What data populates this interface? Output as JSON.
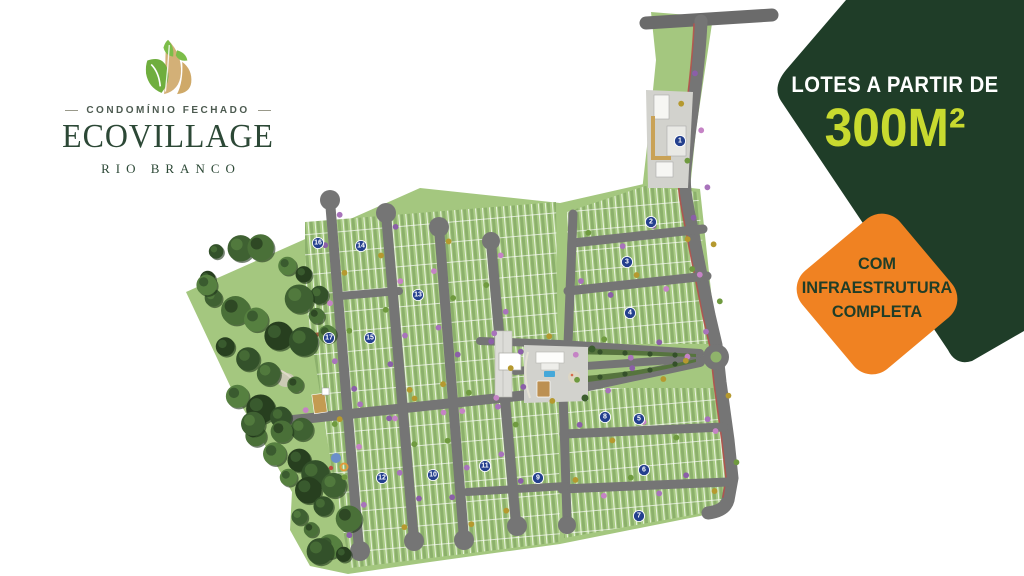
{
  "logo": {
    "tagline": "CONDOMÍNIO FECHADO",
    "name": "ECOVILLAGE",
    "location": "RIO BRANCO"
  },
  "offer": {
    "line1": "LOTES A PARTIR DE",
    "size": "300M²",
    "badge_lines": [
      "COM",
      "INFRAESTRUTURA",
      "COMPLETA"
    ],
    "colors": {
      "banner_green": "#1f3d28",
      "highlight_lime": "#c8da2f",
      "badge_orange": "#f08222",
      "badge_text_green": "#1f3d28"
    }
  },
  "map": {
    "colors": {
      "land_green": "#a4c77f",
      "lot_green": "#a9cc84",
      "road_gray": "#757575",
      "forest_green": "#33512a",
      "marker_blue": "#24408e",
      "bike_lane_red": "#b5524c"
    },
    "block_markers": [
      {
        "n": "1",
        "x": 680,
        "y": 141
      },
      {
        "n": "2",
        "x": 651,
        "y": 222
      },
      {
        "n": "3",
        "x": 627,
        "y": 262
      },
      {
        "n": "4",
        "x": 630,
        "y": 313
      },
      {
        "n": "5",
        "x": 639,
        "y": 419
      },
      {
        "n": "6",
        "x": 644,
        "y": 470
      },
      {
        "n": "7",
        "x": 639,
        "y": 516
      },
      {
        "n": "8",
        "x": 605,
        "y": 417
      },
      {
        "n": "9",
        "x": 538,
        "y": 478
      },
      {
        "n": "10",
        "x": 433,
        "y": 475
      },
      {
        "n": "11",
        "x": 485,
        "y": 466
      },
      {
        "n": "12",
        "x": 382,
        "y": 478
      },
      {
        "n": "13",
        "x": 418,
        "y": 295
      },
      {
        "n": "14",
        "x": 361,
        "y": 246
      },
      {
        "n": "15",
        "x": 370,
        "y": 338
      },
      {
        "n": "16",
        "x": 318,
        "y": 243
      },
      {
        "n": "17",
        "x": 329,
        "y": 338
      }
    ]
  }
}
